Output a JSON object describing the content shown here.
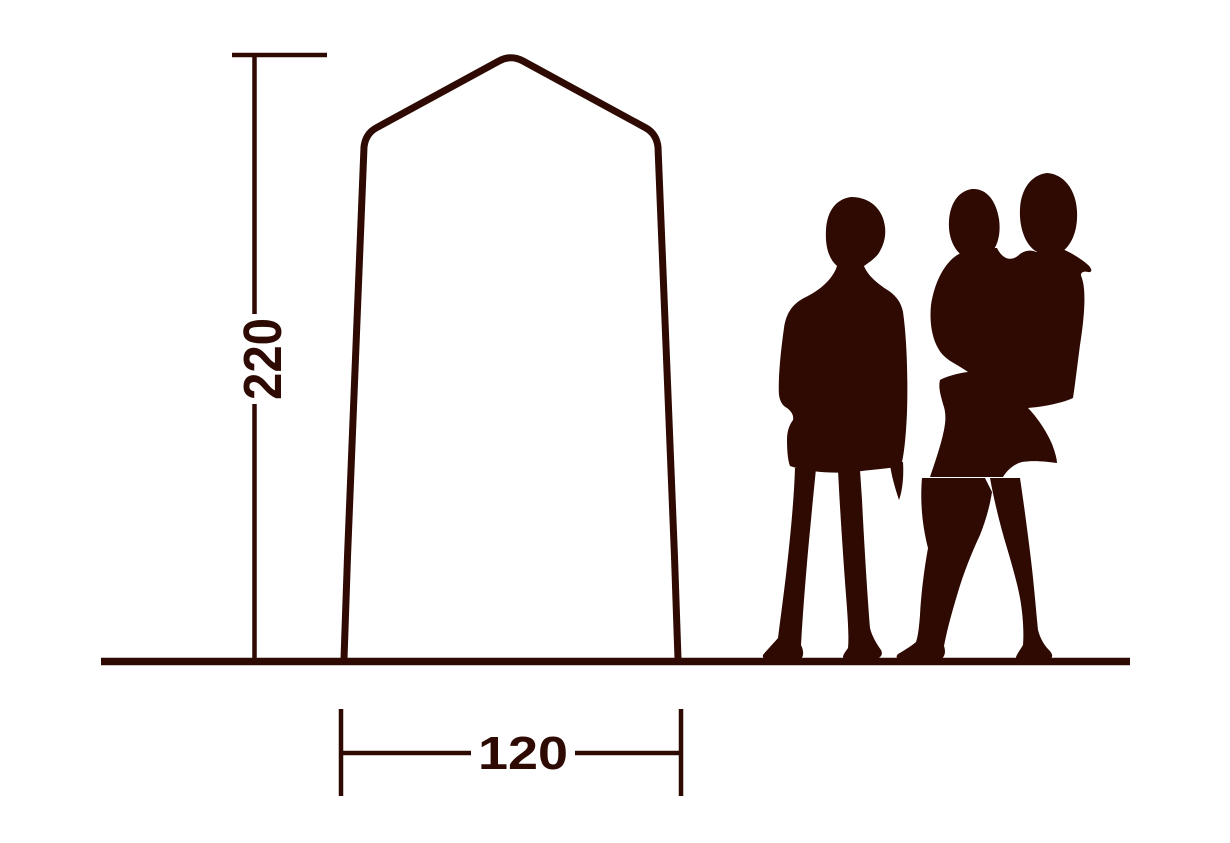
{
  "diagram": {
    "title": "tent-dimension-diagram",
    "height_dimension": {
      "value": "220"
    },
    "width_dimension": {
      "value": "120"
    },
    "colors": {
      "ink": "#2e0a03",
      "background": "#ffffff"
    },
    "shapes": [
      "tent-outline",
      "ground-line",
      "height-dimension-line",
      "width-dimension-line",
      "woman-silhouette",
      "woman-with-child-silhouette"
    ]
  }
}
